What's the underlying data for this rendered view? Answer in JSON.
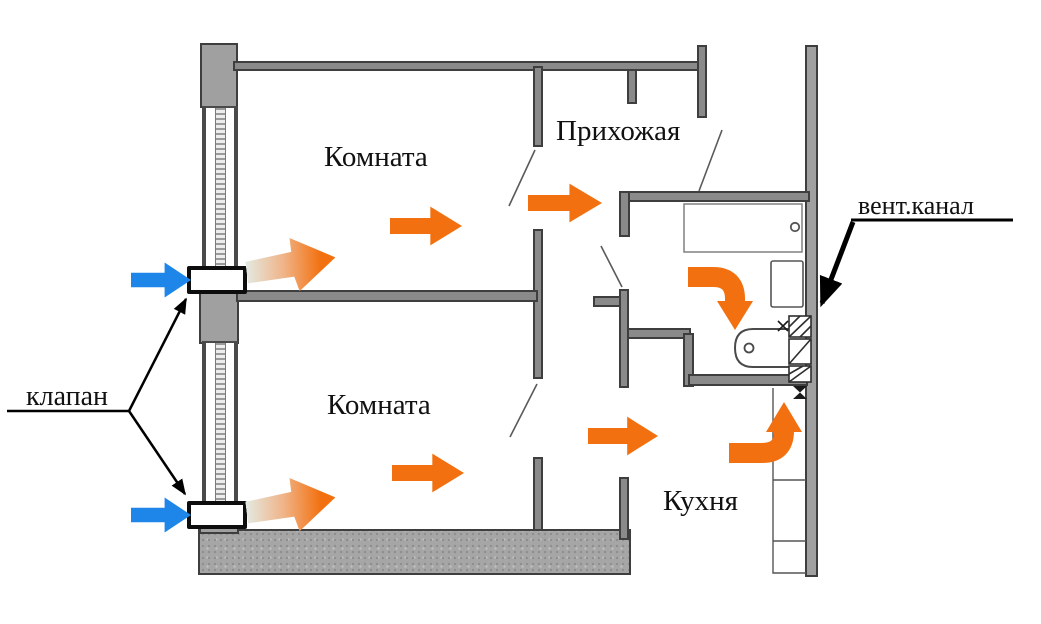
{
  "diagram": {
    "rooms": {
      "room_top": "Комната",
      "room_bottom": "Комната",
      "hallway": "Прихожая",
      "kitchen": "Кухня"
    },
    "callouts": {
      "valve": "клапан",
      "vent_channel": "вент.канал"
    },
    "colors": {
      "flow_arrow": "#f2700f",
      "intake_arrow": "#1e86e8",
      "interior_wall_fill": "#8a8a8a",
      "wall_outline": "#3e3e3e",
      "outer_wall_fill": "#a6a6a6",
      "text": "#111111",
      "background": "#ffffff"
    },
    "icons": {
      "intake_arrows": "blue-right-arrow",
      "supply_arrows": "gradient-fade-arrow",
      "flow_arrows": "orange-flow-arrow",
      "vent_shaft": "hatched-duct-blocks"
    }
  }
}
